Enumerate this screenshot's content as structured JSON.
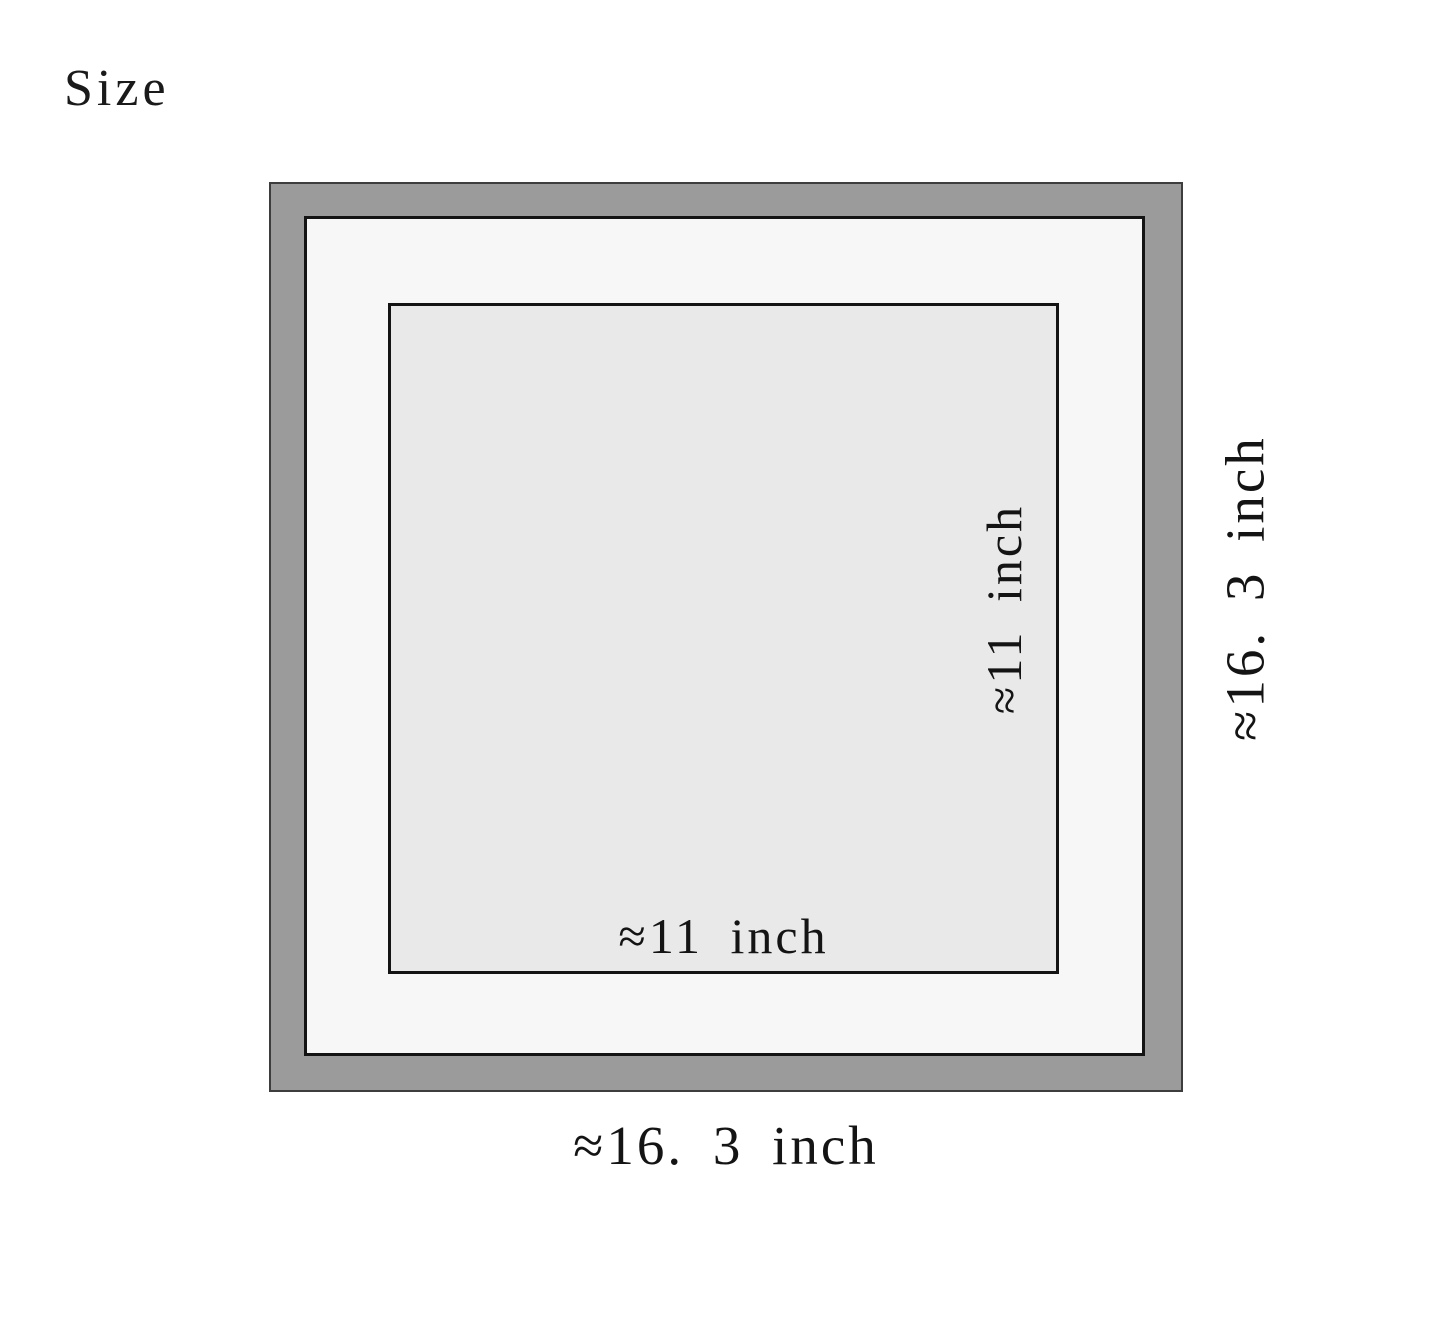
{
  "page": {
    "title": "Size",
    "background": "#ffffff"
  },
  "diagram": {
    "frame": {
      "fill": "#9b9b9b",
      "outline": "#3d3d3d"
    },
    "mat": {
      "fill": "#f7f7f7",
      "outline": "#141414"
    },
    "opening": {
      "fill": "#e9e9e9",
      "outline": "#141414"
    },
    "labels": {
      "opening_width": "≈11 inch",
      "opening_height": "≈11 inch",
      "frame_width": "≈16. 3 inch",
      "frame_height": "≈16. 3 inch"
    }
  }
}
